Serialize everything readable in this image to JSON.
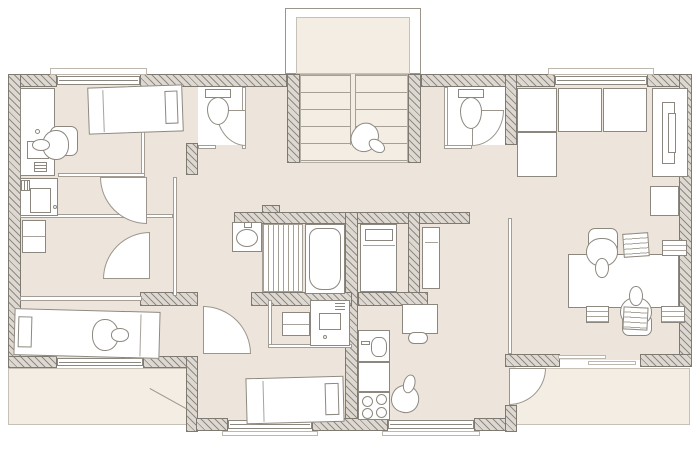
{
  "document": {
    "type": "architectural floor plan",
    "description": "residential storey with central stairwell, two wc rooms, bathroom, kitchen, bedrooms, office room and terraces",
    "visible_text": ""
  },
  "palette": {
    "background": "#ffffff",
    "floor": "#ede5db",
    "floor_light": "#f3ede4",
    "wall_hatch_fill": "#ddd8d1",
    "wall_hatch_stripe": "#8f8a81",
    "wall_border": "#7e7971",
    "furniture_line": "#8d887f",
    "furniture_fill": "#ffffff",
    "thin_line": "#a39d94"
  },
  "inventory": {
    "beds": 5,
    "persons": 6,
    "toilets": 2,
    "washbasins": 2,
    "bathtubs": 1,
    "stair_flights": 2,
    "desks_tables": 4,
    "cabinets_wardrobes": 8,
    "windows": 7,
    "doors": 8,
    "terraces": 2,
    "kitchen": {
      "sink": 1,
      "counter": 1,
      "stove_burners": 4,
      "table": 1
    }
  },
  "icon_names": [
    "bed-icon",
    "person-icon",
    "toilet-icon",
    "washbasin-icon",
    "bathtub-icon",
    "stairs-icon",
    "desk-icon",
    "monitor-icon",
    "printer-icon",
    "keyboard-icon",
    "stove-icon",
    "kitchen-sink-icon",
    "wardrobe-icon",
    "cabinet-icon",
    "door-arc-icon",
    "window-icon",
    "paper-icon",
    "chair-icon"
  ]
}
